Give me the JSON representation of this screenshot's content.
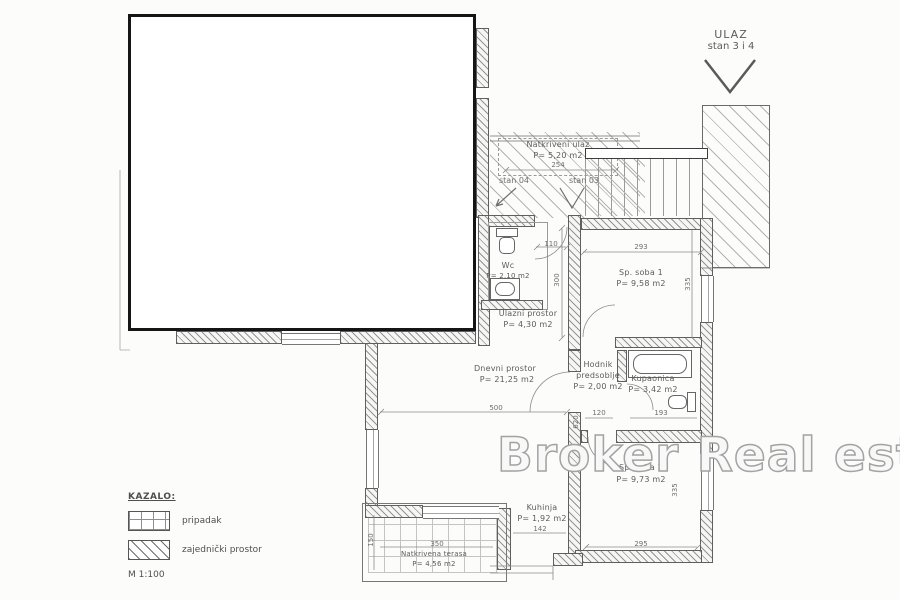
{
  "watermark": "Broker Real estate",
  "entrance_sign": {
    "line1": "ULAZ",
    "line2": "stan 3 i 4"
  },
  "unit_labels": {
    "stan_04": "stan 04",
    "stan_03": "stan 03"
  },
  "rooms": {
    "natkriveni_ulaz": {
      "name": "Natkriveni ulaz",
      "area": "P= 5,20 m2",
      "width_dim": "254"
    },
    "wc": {
      "name": "Wc",
      "area": "P= 2,10 m2"
    },
    "ulazni_prostor": {
      "name": "Ulazni prostor",
      "area": "P= 4,30 m2"
    },
    "sp_soba_1": {
      "name": "Sp. soba 1",
      "area": "P= 9,58 m2",
      "width_dim": "293",
      "height_dim": "335"
    },
    "dnevni_prostor": {
      "name": "Dnevni prostor",
      "area": "P= 21,25 m2",
      "width_dim": "500",
      "height_dim": "620"
    },
    "hodnik": {
      "name_line1": "Hodnik",
      "name_line2": "predsoblje",
      "area": "P= 2,00 m2",
      "width_dim": "120"
    },
    "kupaonica": {
      "name": "Kupaonica",
      "area": "P= 3,42 m2",
      "width_dim": "193"
    },
    "sp_soba_2": {
      "name": "Sp. soba 2",
      "area": "P= 9,73 m2",
      "width_dim": "295",
      "height_dim": "335"
    },
    "kuhinja": {
      "name": "Kuhinja",
      "area": "P= 1,92 m2",
      "width_dim": "142"
    },
    "natkrivena_terasa": {
      "name": "Natkrivena terasa",
      "area": "P= 4,56 m2",
      "width_dim": "350",
      "height_dim": "150"
    }
  },
  "dims": {
    "entry_door": "110",
    "entry_side": "300"
  },
  "legend": {
    "title": "KAZALO:",
    "items": [
      {
        "label": "pripadak"
      },
      {
        "label": "zajednički prostor"
      }
    ],
    "scale": "M 1:100"
  },
  "colors": {
    "background": "#fcfcfb",
    "wall_line": "#5f5f5f",
    "hatch": "#949494",
    "text": "#5c5c5c",
    "masked_unit_border": "#151515",
    "watermark_stroke": "#a3a3a3"
  }
}
